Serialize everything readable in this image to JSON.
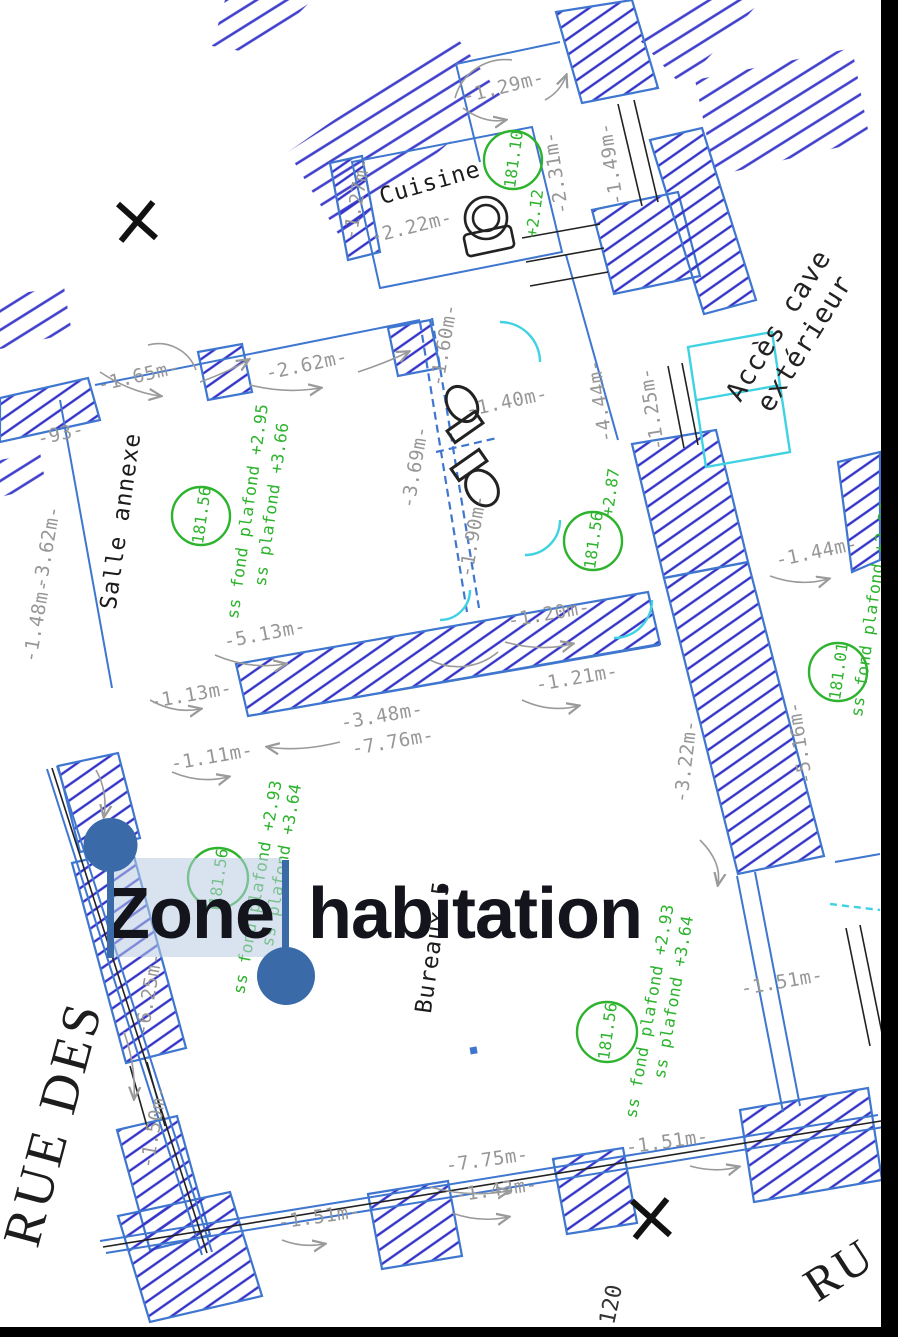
{
  "overlay": {
    "text": "Zone habitation",
    "word1": "Zone",
    "word2": "habitation",
    "selected_word": "Zone",
    "handle_color": "#3a6ba8",
    "highlight_color": "#b9cce3",
    "text_color": "#14141c"
  },
  "plan": {
    "rooms": [
      "Cuisine",
      "Salle annexe",
      "Bureaux 5"
    ],
    "streets": [
      "RUE DES",
      "RU"
    ],
    "access_label": [
      "Accès cave",
      "extérieur"
    ],
    "marker": "120",
    "levels": {
      "c1": "181.10",
      "c1d": "+2.12",
      "c2": "181.56",
      "c2a": "ss fond plafond +2.95",
      "c2b": "ss plafond +3.66",
      "c3": "181.56",
      "c3d": "+2.87",
      "c4": "181.01",
      "c5": "181.56",
      "c5a": "ss fond plafond +2.93",
      "c5b": "ss plafond +3.64",
      "c6": "181.56",
      "c6a": "ss fond plafond +2.93",
      "c6b": "ss plafond +3.64",
      "edge": "ss fond plafond +2.86"
    },
    "d": [
      "-1.29m-",
      "-2.31m-",
      "-1.49m-",
      "-1.27m-",
      "-2.22m-",
      "-1.65m-",
      "-93-",
      "-2.62m-",
      "-3.62m-",
      "-1.48m-",
      "-5.13m-",
      "-1.60m-",
      "-1.40m-",
      "-3.69m-",
      "-1.90m-",
      "-4.44m-",
      "-1.25m-",
      "-1.20m-",
      "-1.13m-",
      "-1.11m-",
      "-3.48m-",
      "-7.76m-",
      "-1.21m-",
      "-1.44m-",
      "-5.16m-",
      "-3.22m-",
      "-6.25m-",
      "-1.50m-",
      "-1.51m-",
      "-7.75m-",
      "-1.43m-",
      "-1.51m-",
      "-1.51m-"
    ],
    "colors": {
      "wall_outline": "#3f76cf",
      "hatch": "#3434c8",
      "annotation_green": "#2db32d",
      "dimension_gray": "#979797",
      "cyan": "#3fd2e2",
      "line_black": "#222222"
    }
  }
}
